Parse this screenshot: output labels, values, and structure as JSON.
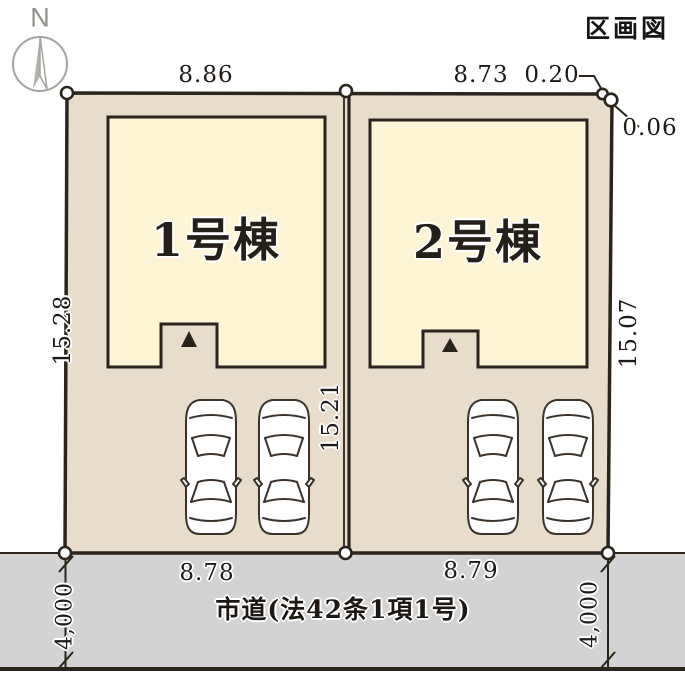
{
  "title": "区画図",
  "compass": {
    "label": "N"
  },
  "buildings": [
    {
      "label": "1号棟"
    },
    {
      "label": "2号棟"
    }
  ],
  "dimensions": {
    "lot1_top": "8.86",
    "lot2_top": "8.73",
    "corner_offset_top": "0.20",
    "corner_offset_right": "0.06",
    "lot1_left": "15.28",
    "lot2_right": "15.07",
    "center_boundary": "15.21",
    "lot1_bottom": "8.78",
    "lot2_bottom": "8.79",
    "road_width_left": "4,000",
    "road_width_right": "4,000"
  },
  "road": {
    "label": "市道(法42条1項1号)"
  },
  "icons": {
    "north_arrow": "north-arrow-icon",
    "car": "car-top-view-icon",
    "entrance": "entrance-triangle-icon",
    "survey_point": "boundary-marker-icon"
  },
  "colors": {
    "lot_fill": "#e8dccb",
    "building_fill": "#fdf5d6",
    "road_fill": "#d3d3d3",
    "outline": "#2b241d",
    "compass_gray": "#a5a39e",
    "text": "#1f1a16"
  }
}
